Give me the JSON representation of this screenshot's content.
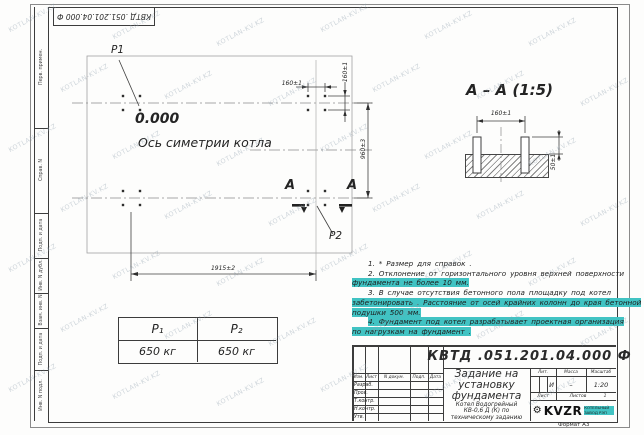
{
  "watermark": {
    "text": "KOTLAN-KV.KZ"
  },
  "stamp_top": {
    "doc_number": "КВТД .051.201.04.000 Ф"
  },
  "margin_labels": [
    "Перв. примен.",
    "Справ. N",
    "Подп. и дата",
    "Инв. N дубл.",
    "Взам. инв. N",
    "Подп. и дата",
    "Инв. N подл."
  ],
  "plan": {
    "p1": "P1",
    "p2": "P2",
    "elevation": "0.000",
    "axis_label": "Ось симетрии котла",
    "section_letter_left": "А",
    "section_letter_right": "А",
    "dim_width": "1915±2",
    "dim_height": "960±3",
    "dim_bolt_h": "160±1",
    "dim_bolt_v": "160±1"
  },
  "section_view": {
    "title": "А – А (1:5)",
    "dim_spacing": "160±1",
    "dim_protrusion": "50±1"
  },
  "notes": {
    "lines": [
      {
        "text": "1. * Размер для справок .",
        "hl": false
      },
      {
        "text": "2. Отклонение от горизонтального уровня верхней поверхности",
        "hl": false
      },
      {
        "text": "фундамента не более 10 мм.",
        "hl": true
      },
      {
        "text": "3. В случае отсутствия бетонного пола площадку под котел",
        "hl": false
      },
      {
        "text": "забетонировать . Расстояние от осей крайних колонн до края бетонной",
        "hl": true
      },
      {
        "text": "подушки 500 мм.",
        "hl": true
      },
      {
        "text": "4. Фундамент под котел разрабатывает проектная организация",
        "hl": true
      },
      {
        "text": "по нагрузкам на фундамент .",
        "hl": true
      }
    ]
  },
  "load_table": {
    "headers": [
      "P₁",
      "P₂"
    ],
    "values": [
      "650 кг",
      "650 кг"
    ]
  },
  "titleblock": {
    "doc_number": "КВТД .051.201.04.000 Ф",
    "title": "Задание на установку фундамента",
    "subtitle": "Котел Водогрейный КВ-0,6 Д (К) по техническому заданию",
    "cols": [
      "Изм.",
      "Лист",
      "N докум.",
      "Подп.",
      "Дата"
    ],
    "roles": [
      "Разраб.",
      "Пров.",
      "Т.контр.",
      "Н.контр.",
      "Утв."
    ],
    "lit_label": "Лит.",
    "mass_label": "Масса",
    "scale_label": "Масштаб",
    "lit_value": "И",
    "mass_value": "–",
    "scale_value": "1:20",
    "sheet_label": "Лист",
    "sheets_label": "Листов",
    "sheets_value": "1",
    "logo_text": "KVZR",
    "logo_sub": "КОТЕЛЬНЫЙ ЗАВОД РЭП",
    "format_label": "Формат А3"
  },
  "colors": {
    "highlight": "#41c3c3",
    "line": "#3c3c3c"
  }
}
